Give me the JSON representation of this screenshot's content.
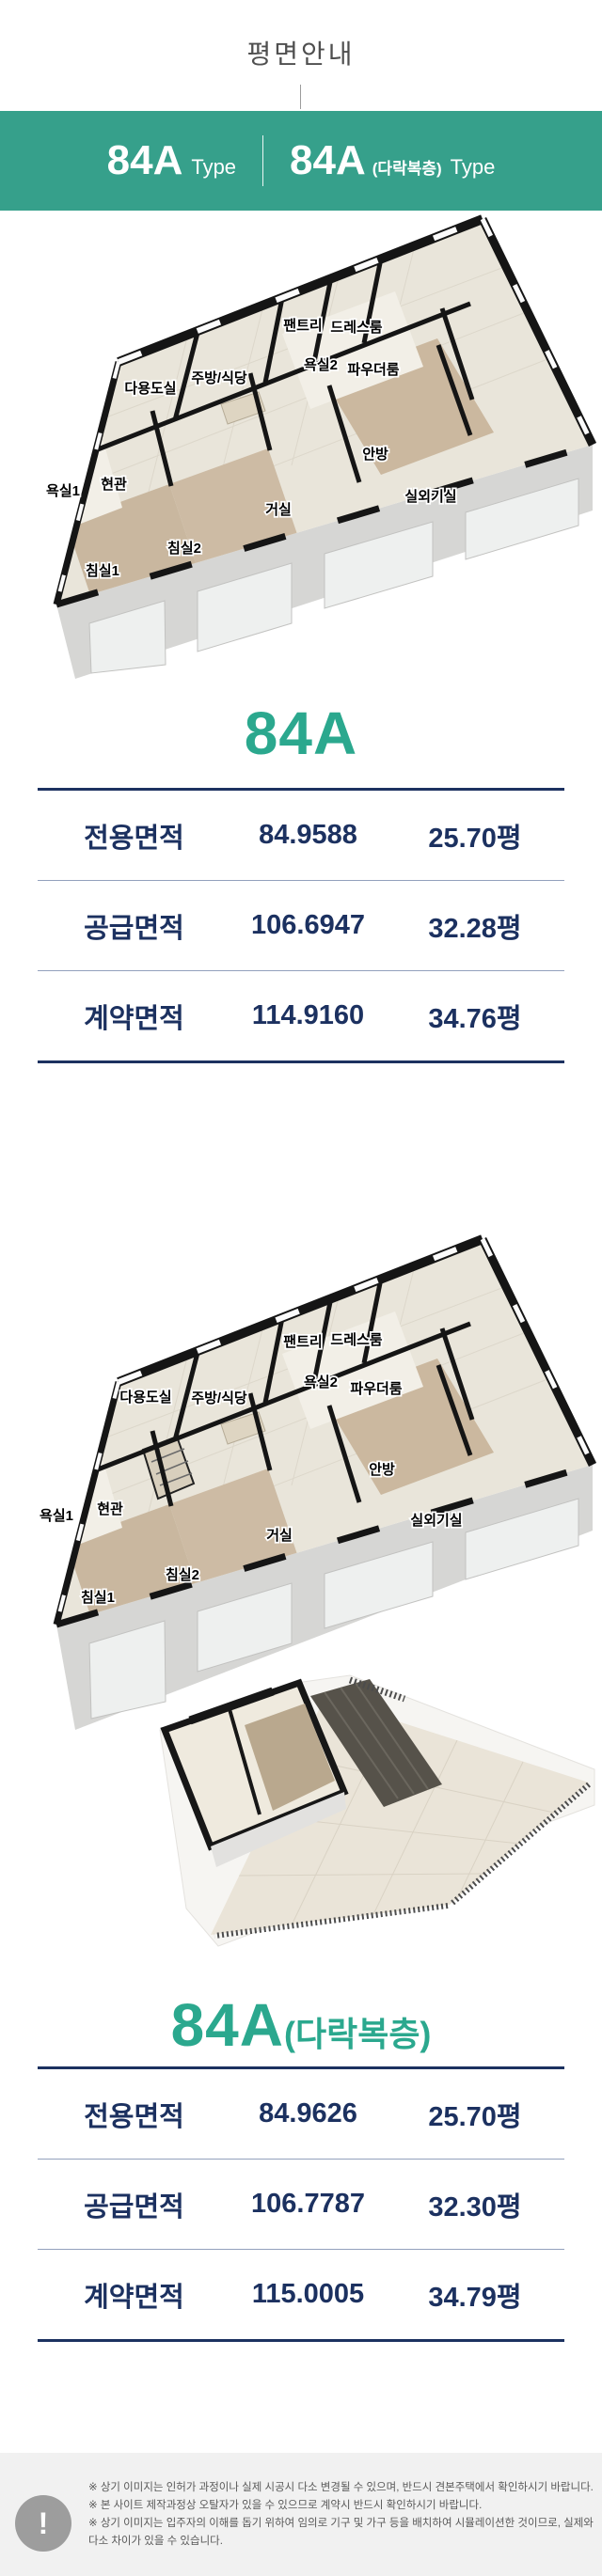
{
  "page_title": "평면안내",
  "type_banner": {
    "left": {
      "code": "84A",
      "suffix": "Type"
    },
    "right": {
      "code": "84A",
      "paren": "(다락복층)",
      "suffix": "Type"
    }
  },
  "plans": {
    "rooms": [
      "팬트리",
      "드레스룸",
      "욕실2",
      "파우더룸",
      "주방/식당",
      "다용도실",
      "욕실1",
      "현관",
      "안방",
      "거실",
      "실외기실",
      "침실2",
      "침실1"
    ]
  },
  "section1": {
    "title": "84A",
    "table": {
      "rows": [
        {
          "label": "전용면적",
          "value": "84.9588",
          "pyeong": "25.70평"
        },
        {
          "label": "공급면적",
          "value": "106.6947",
          "pyeong": "32.28평"
        },
        {
          "label": "계약면적",
          "value": "114.9160",
          "pyeong": "34.76평"
        }
      ]
    }
  },
  "section2": {
    "title": "84A",
    "title_paren": "(다락복층)",
    "table": {
      "rows": [
        {
          "label": "전용면적",
          "value": "84.9626",
          "pyeong": "25.70평"
        },
        {
          "label": "공급면적",
          "value": "106.7787",
          "pyeong": "32.30평"
        },
        {
          "label": "계약면적",
          "value": "115.0005",
          "pyeong": "34.79평"
        }
      ]
    }
  },
  "footer": {
    "icon": "!",
    "notes": [
      "※ 상기 이미지는 인허가 과정이나 실제 시공시 다소 변경될 수 있으며, 반드시 견본주택에서 확인하시기 바랍니다.",
      "※ 본 사이트 제작과정상 오탈자가 있을 수 있으므로 계약시 반드시 확인하시기 바랍니다.",
      "※ 상기 이미지는 입주자의 이해를 돕기 위하여 임의로 기구 및 가구 등을 배치하여 시뮬레이션한 것이므로, 실제와 다소 차이가 있을 수 있습니다."
    ]
  },
  "colors": {
    "teal": "#36a08b",
    "navy": "#1c3160"
  }
}
